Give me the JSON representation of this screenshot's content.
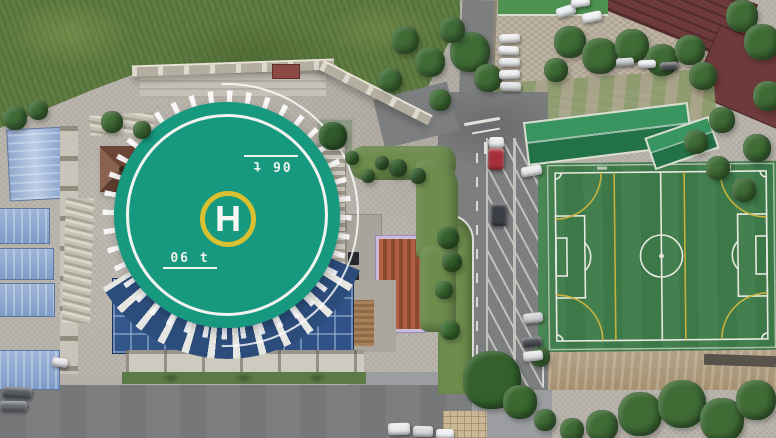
{
  "scene_description": "Aerial drone view: rooftop helipad plaza with glass atrium, blue-roofed sheds, campus road with angled parking, gravel car lot and an artificial-turf soccer pitch",
  "helipad": {
    "letter": "H",
    "weight_marking": "06 t"
  },
  "colors": {
    "plaza": "#b8b4ab",
    "asphalt": "#7d7e80",
    "gravel": "#b7ad9c",
    "grass_wild": "#5f7c42",
    "lawn": "#6d8d4d",
    "helipad_pad": "#17997f",
    "helipad_ring": "#d9c02e",
    "helipad_lines": "#f2f3ef",
    "glass_roof": "#2c4d7c",
    "shed_roof": "#7e9cc8",
    "roof_maroon": "#6e3a3c",
    "roof_orange": "#b26041",
    "stand_roof": "#39955f",
    "turf": "#3d7848",
    "turf_light": "#447f50",
    "field_line": "#e7e8e0",
    "field_line_secondary": "#cdb53e",
    "tree": "#3f6b35"
  },
  "objects": {
    "trees": [
      {
        "x": 15,
        "y": 118,
        "r": 12
      },
      {
        "x": 38,
        "y": 110,
        "r": 10
      },
      {
        "x": 112,
        "y": 122,
        "r": 11
      },
      {
        "x": 142,
        "y": 130,
        "r": 9
      },
      {
        "x": 333,
        "y": 136,
        "r": 14,
        "color": "#2f5a2b"
      },
      {
        "x": 398,
        "y": 168,
        "r": 9,
        "color": "#355f2e"
      },
      {
        "x": 418,
        "y": 176,
        "r": 8,
        "color": "#355f2e"
      },
      {
        "x": 382,
        "y": 163,
        "r": 7,
        "color": "#355f2e"
      },
      {
        "x": 352,
        "y": 158,
        "r": 7,
        "color": "#3a682f"
      },
      {
        "x": 368,
        "y": 176,
        "r": 7,
        "color": "#3a682f"
      },
      {
        "x": 405,
        "y": 40,
        "r": 14
      },
      {
        "x": 390,
        "y": 80,
        "r": 12
      },
      {
        "x": 470,
        "y": 52,
        "r": 20
      },
      {
        "x": 488,
        "y": 78,
        "r": 14
      },
      {
        "x": 452,
        "y": 30,
        "r": 13
      },
      {
        "x": 430,
        "y": 62,
        "r": 15
      },
      {
        "x": 440,
        "y": 100,
        "r": 11
      },
      {
        "x": 570,
        "y": 42,
        "r": 16
      },
      {
        "x": 600,
        "y": 56,
        "r": 18
      },
      {
        "x": 632,
        "y": 46,
        "r": 17
      },
      {
        "x": 662,
        "y": 60,
        "r": 16
      },
      {
        "x": 690,
        "y": 50,
        "r": 15
      },
      {
        "x": 703,
        "y": 76,
        "r": 14
      },
      {
        "x": 556,
        "y": 70,
        "r": 12
      },
      {
        "x": 742,
        "y": 16,
        "r": 16
      },
      {
        "x": 762,
        "y": 42,
        "r": 18
      },
      {
        "x": 768,
        "y": 96,
        "r": 15
      },
      {
        "x": 757,
        "y": 148,
        "r": 14
      },
      {
        "x": 744,
        "y": 190,
        "r": 12
      },
      {
        "x": 722,
        "y": 120,
        "r": 13
      },
      {
        "x": 696,
        "y": 142,
        "r": 12
      },
      {
        "x": 718,
        "y": 168,
        "r": 12
      },
      {
        "x": 448,
        "y": 238,
        "r": 11,
        "color": "#33602a"
      },
      {
        "x": 452,
        "y": 262,
        "r": 10,
        "color": "#33602a"
      },
      {
        "x": 444,
        "y": 290,
        "r": 9,
        "color": "#3a6b31"
      },
      {
        "x": 450,
        "y": 330,
        "r": 10,
        "color": "#3a6b31"
      },
      {
        "x": 492,
        "y": 380,
        "r": 29,
        "color": "#34602c"
      },
      {
        "x": 520,
        "y": 402,
        "r": 17,
        "color": "#3a682f"
      },
      {
        "x": 540,
        "y": 357,
        "r": 10,
        "color": "#46753a"
      },
      {
        "x": 640,
        "y": 414,
        "r": 22
      },
      {
        "x": 682,
        "y": 404,
        "r": 24
      },
      {
        "x": 722,
        "y": 420,
        "r": 22
      },
      {
        "x": 756,
        "y": 400,
        "r": 20
      },
      {
        "x": 602,
        "y": 426,
        "r": 16
      },
      {
        "x": 572,
        "y": 430,
        "r": 12
      },
      {
        "x": 545,
        "y": 420,
        "r": 11
      }
    ],
    "vehicles": [
      {
        "x": 499,
        "y": 34,
        "w": 21,
        "h": 9,
        "rot": -3,
        "color": "#ececee"
      },
      {
        "x": 498,
        "y": 46,
        "w": 21,
        "h": 9,
        "rot": 2,
        "color": "#f0f0f2"
      },
      {
        "x": 499,
        "y": 58,
        "w": 21,
        "h": 9,
        "rot": 0,
        "color": "#e6e7e9"
      },
      {
        "x": 499,
        "y": 70,
        "w": 21,
        "h": 9,
        "rot": -2,
        "color": "#eeeef0"
      },
      {
        "x": 500,
        "y": 82,
        "w": 21,
        "h": 9,
        "rot": 1,
        "color": "#dfe0e2"
      },
      {
        "x": 556,
        "y": 6,
        "w": 20,
        "h": 10,
        "rot": -18,
        "color": "#eceff1"
      },
      {
        "x": 582,
        "y": 12,
        "w": 20,
        "h": 10,
        "rot": -12,
        "color": "#f1f2f4"
      },
      {
        "x": 571,
        "y": -2,
        "w": 19,
        "h": 9,
        "rot": -8,
        "color": "#f2f3f5"
      },
      {
        "x": 616,
        "y": 58,
        "w": 18,
        "h": 8,
        "rot": -4,
        "color": "#c9cbcf"
      },
      {
        "x": 638,
        "y": 60,
        "w": 18,
        "h": 8,
        "rot": -2,
        "color": "#eceef0"
      },
      {
        "x": 660,
        "y": 62,
        "w": 18,
        "h": 8,
        "rot": -3,
        "color": "#55585e"
      },
      {
        "x": 489,
        "y": 137,
        "w": 15,
        "h": 11,
        "rot": 0,
        "color": "#e9eaec"
      },
      {
        "x": 488,
        "y": 148,
        "w": 16,
        "h": 22,
        "rot": 2,
        "color": "#a5303a"
      },
      {
        "x": 491,
        "y": 203,
        "w": 16,
        "h": 23,
        "rot": 1,
        "color": "#3b3e44"
      },
      {
        "x": 521,
        "y": 166,
        "w": 21,
        "h": 10,
        "rot": -10,
        "color": "#e8e9eb"
      },
      {
        "x": 523,
        "y": 313,
        "w": 20,
        "h": 10,
        "rot": -6,
        "color": "#cfd1d4"
      },
      {
        "x": 522,
        "y": 337,
        "w": 20,
        "h": 10,
        "rot": -5,
        "color": "#4a4d52"
      },
      {
        "x": 523,
        "y": 351,
        "w": 20,
        "h": 10,
        "rot": -6,
        "color": "#e4e5e7"
      },
      {
        "x": 388,
        "y": 423,
        "w": 22,
        "h": 12,
        "rot": -2,
        "color": "#e9eaec"
      },
      {
        "x": 413,
        "y": 426,
        "w": 20,
        "h": 11,
        "rot": 1,
        "color": "#d8d9db"
      },
      {
        "x": 436,
        "y": 429,
        "w": 18,
        "h": 10,
        "rot": 0,
        "color": "#eef0f2"
      },
      {
        "x": 2,
        "y": 387,
        "w": 30,
        "h": 11,
        "rot": 3,
        "color": "#555a60"
      },
      {
        "x": 0,
        "y": 401,
        "w": 27,
        "h": 10,
        "rot": 1,
        "color": "#6a6e74"
      },
      {
        "x": 52,
        "y": 358,
        "w": 16,
        "h": 9,
        "rot": 8,
        "color": "#e8e8ea"
      }
    ]
  }
}
